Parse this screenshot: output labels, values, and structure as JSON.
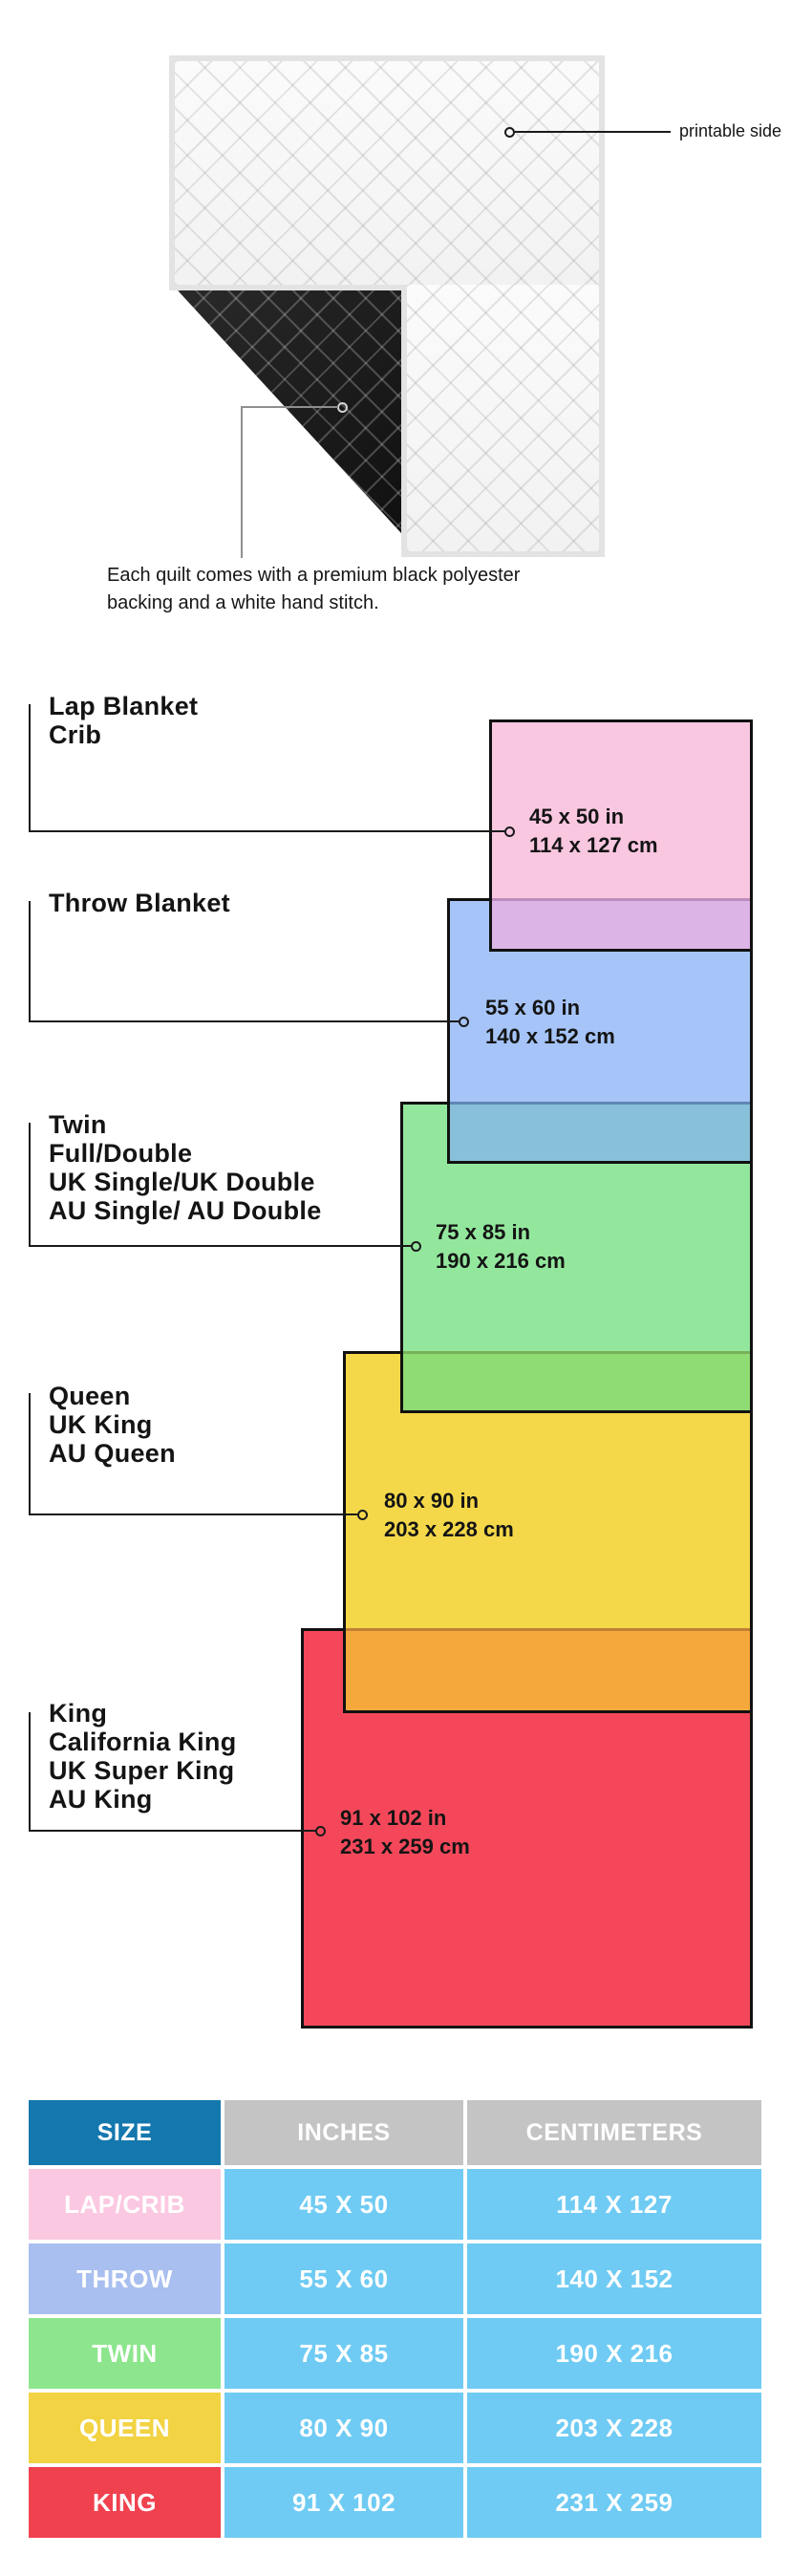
{
  "quilt": {
    "printable_label": "printable side",
    "caption": "Each quilt comes with a premium black polyester backing and a white hand stitch."
  },
  "diagram": {
    "blankets": [
      {
        "id": "lap",
        "names": [
          "Lap Blanket",
          "Crib"
        ],
        "inches": "45 x 50 in",
        "centimeters": "114 x 127 cm",
        "fill": "#FAC7E0",
        "overlap_fill": "#DDB4E6",
        "overlap_border": "#BC8CBE"
      },
      {
        "id": "throw",
        "names": [
          "Throw Blanket"
        ],
        "inches": "55 x 60 in",
        "centimeters": "140 x 152 cm",
        "fill": "#A6C4F8",
        "overlap_fill": "#87C0D8",
        "overlap_border": "#5F86B5"
      },
      {
        "id": "twin",
        "names": [
          "Twin",
          "Full/Double",
          "UK Single/UK Double",
          "AU Single/ AU Double"
        ],
        "inches": "75 x 85 in",
        "centimeters": "190 x 216 cm",
        "fill": "#93E79D",
        "overlap_fill": "#8FDB74",
        "overlap_border": "#79B159"
      },
      {
        "id": "queen",
        "names": [
          "Queen",
          "UK King",
          "AU Queen"
        ],
        "inches": "80 x 90 in",
        "centimeters": "203 x 228 cm",
        "fill": "#F4D84A",
        "overlap_fill": "#F5A93C",
        "overlap_border": "#C07F35"
      },
      {
        "id": "king",
        "names": [
          "King",
          "California King",
          "UK Super King",
          "AU King"
        ],
        "inches": "91 x 102 in",
        "centimeters": "231 x 259 cm",
        "fill": "#F4485A"
      }
    ]
  },
  "table": {
    "headers": [
      "SIZE",
      "INCHES",
      "CENTIMETERS"
    ],
    "header_size_color": "#1478AE",
    "header_units_color": "#C4C4C4",
    "value_cell_color": "#6FCBF3",
    "rows": [
      {
        "size": "LAP/CRIB",
        "inches": "45 X 50",
        "centimeters": "114 X 127",
        "color": "#FBC8E1"
      },
      {
        "size": "THROW",
        "inches": "55 X 60",
        "centimeters": "140 X 152",
        "color": "#A9BFF0"
      },
      {
        "size": "TWIN",
        "inches": "75 X 85",
        "centimeters": "190 X 216",
        "color": "#8DE68D"
      },
      {
        "size": "QUEEN",
        "inches": "80 X 90",
        "centimeters": "203 X 228",
        "color": "#F2D343"
      },
      {
        "size": "KING",
        "inches": "91 X 102",
        "centimeters": "231 X 259",
        "color": "#F0414F"
      }
    ]
  }
}
